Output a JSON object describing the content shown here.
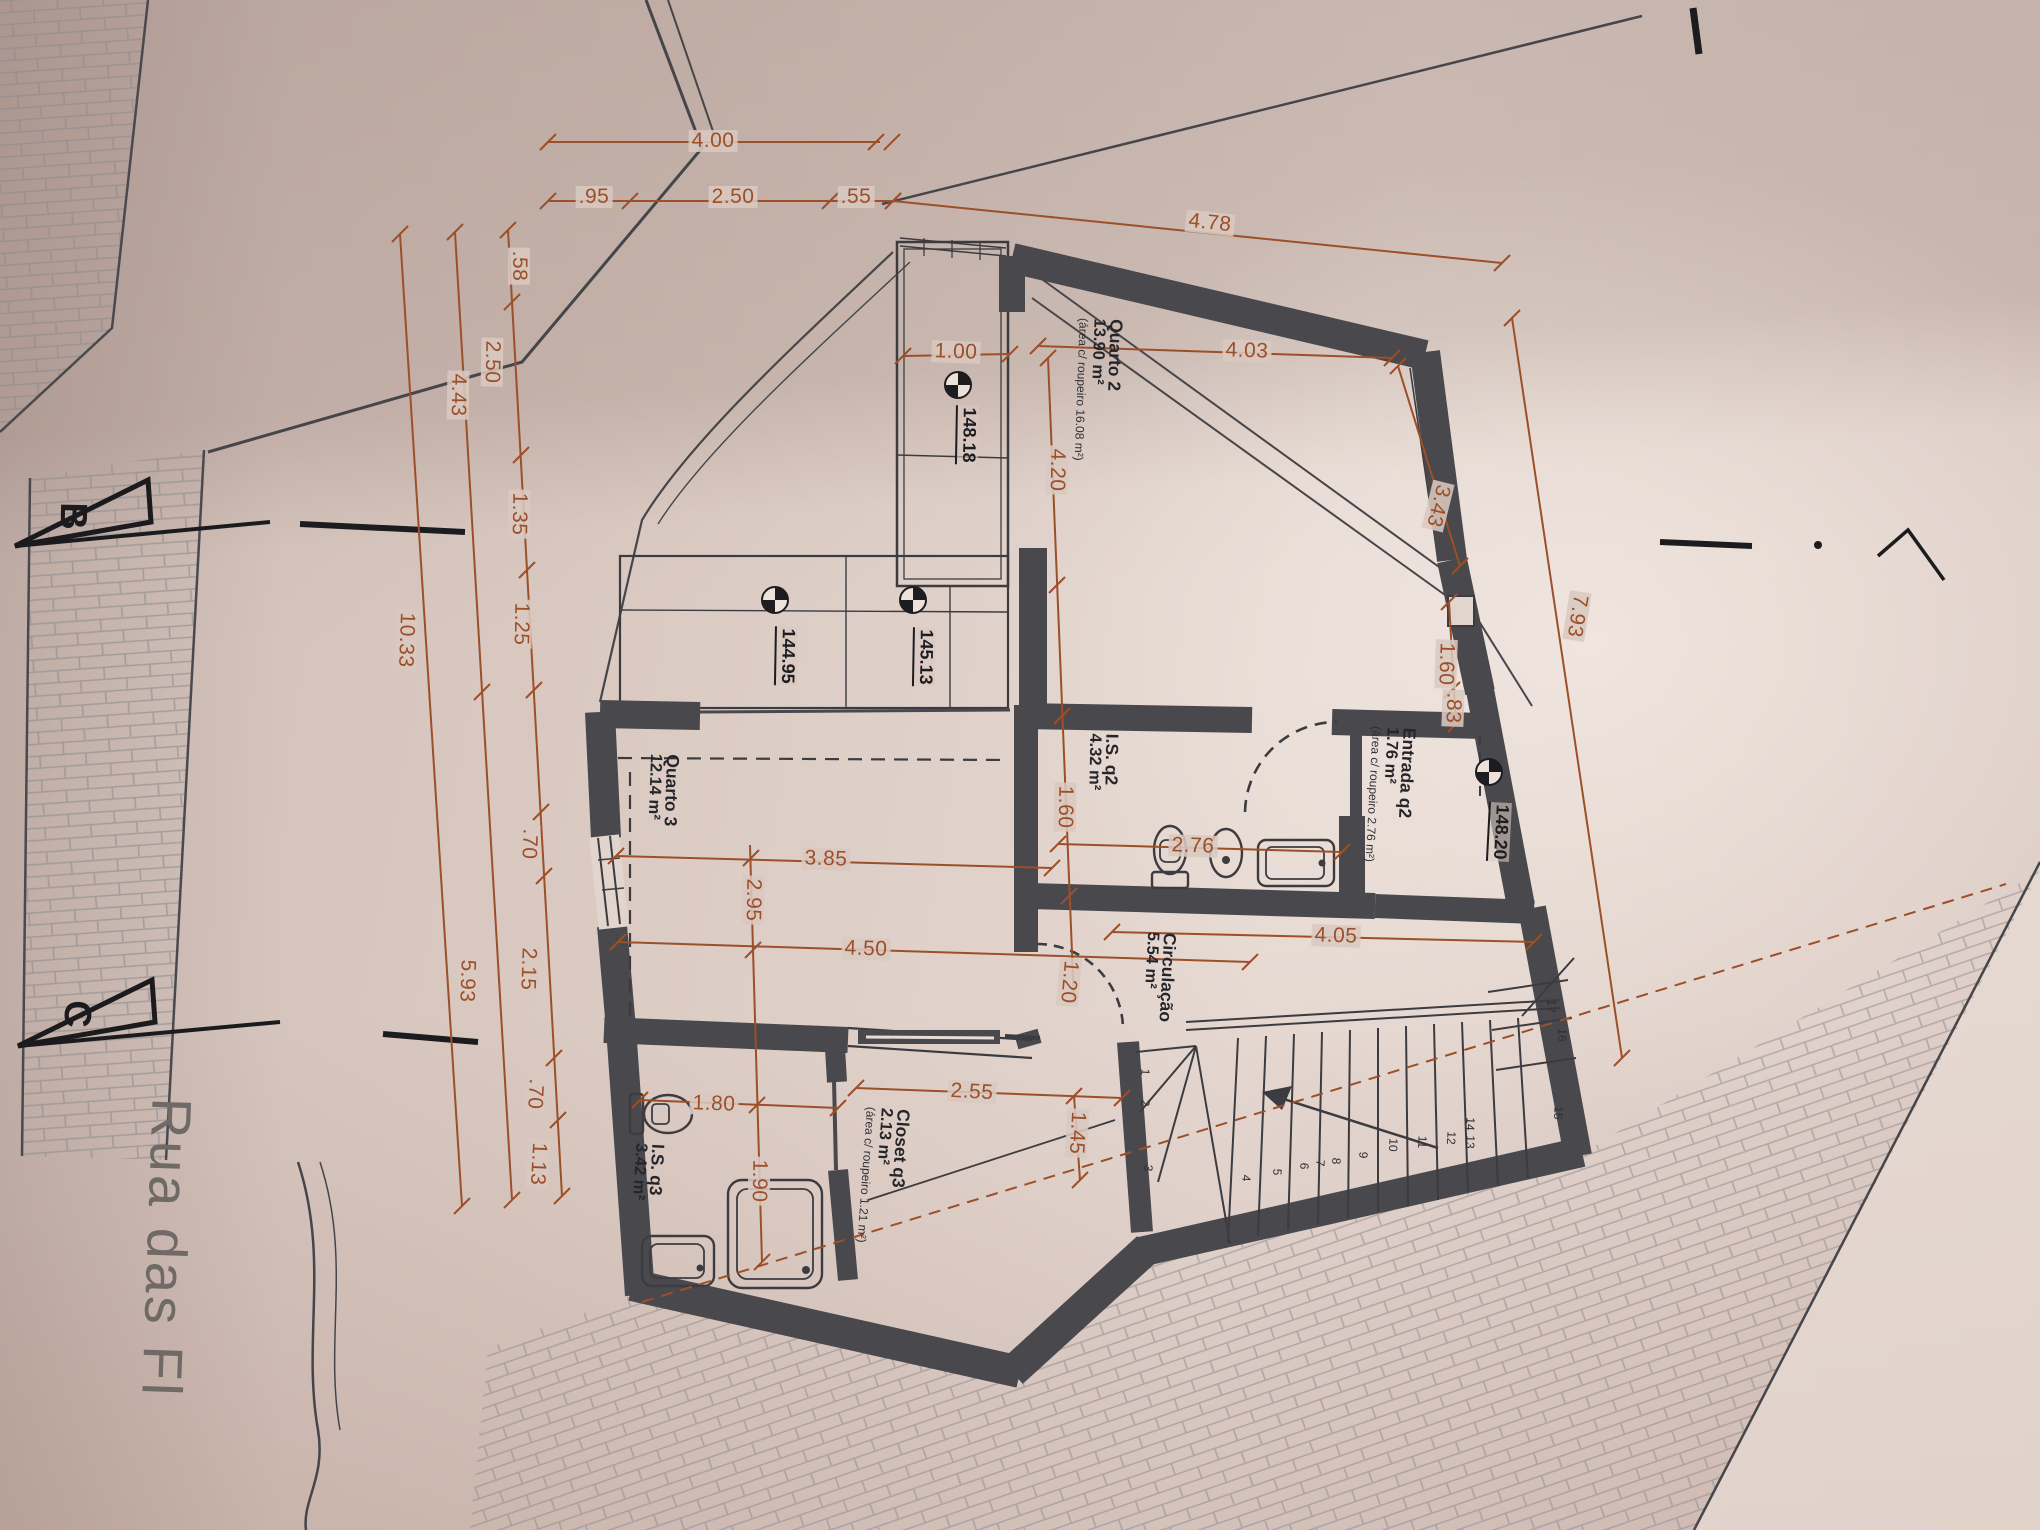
{
  "street": {
    "name": "Rua das Fl"
  },
  "section_markers": {
    "b": "B",
    "c": "C"
  },
  "rooms": {
    "quarto2": {
      "name": "Quarto 2",
      "area": "13.90 m²",
      "note": "(área c/ roupeiro 16.08 m²)"
    },
    "quarto3": {
      "name": "Quarto 3",
      "area": "12.14 m²"
    },
    "is_q2": {
      "name": "I.S. q2",
      "area": "4.32 m²"
    },
    "entrada_q2": {
      "name": "Entrada q2",
      "area": "1.76 m²",
      "note": "(área c/ roupeiro 2.76 m²)"
    },
    "circulacao": {
      "name": "Circulação",
      "area": "5.54 m²"
    },
    "closet_q3": {
      "name": "Closet q3",
      "area": "2.13 m²",
      "note": "(área c/ roupeiro 1.21 m²)"
    },
    "is_q3": {
      "name": "I.S. q3",
      "area": "3.42 m²"
    }
  },
  "levels": {
    "quarto2_roupeiro": "148.18",
    "terrace_left": "144.95",
    "terrace_right": "145.13",
    "entry_landing": "148.20"
  },
  "dimensions": {
    "d_4_00": "4.00",
    "d_0_95": ".95",
    "d_2_50_top": "2.50",
    "d_0_55": ".55",
    "d_4_78": "4.78",
    "d_0_58": ".58",
    "d_2_50_left": "2.50",
    "d_4_43": "4.43",
    "d_10_33": "10.33",
    "d_1_35": "1.35",
    "d_1_25": "1.25",
    "d_0_70_a": ".70",
    "d_2_15": "2.15",
    "d_0_70_b": ".70",
    "d_1_13": "1.13",
    "d_5_93": "5.93",
    "d_1_00": "1.00",
    "d_4_03": "4.03",
    "d_4_20": "4.20",
    "d_3_43": "3.43",
    "d_7_93": "7.93",
    "d_1_60_is": "1.60",
    "d_2_76": "2.76",
    "d_3_85": "3.85",
    "d_2_95": "2.95",
    "d_4_50": "4.50",
    "d_4_05": "4.05",
    "d_1_60_ent": "1.60",
    "d_0_83": ".83",
    "d_1_20": "1.20",
    "d_2_55": "2.55",
    "d_1_80": "1.80",
    "d_1_45": "1.45",
    "d_1_90": "1.90"
  },
  "stairs": {
    "numbers": [
      "1",
      "2",
      "3",
      "4",
      "5",
      "6",
      "7",
      "8",
      "9",
      "10",
      "11",
      "12",
      "13",
      "14",
      "15",
      "16",
      "17"
    ]
  },
  "colors": {
    "dimension": "#9c4f28",
    "wall": "#48484d",
    "paper": "#dccdc5"
  }
}
